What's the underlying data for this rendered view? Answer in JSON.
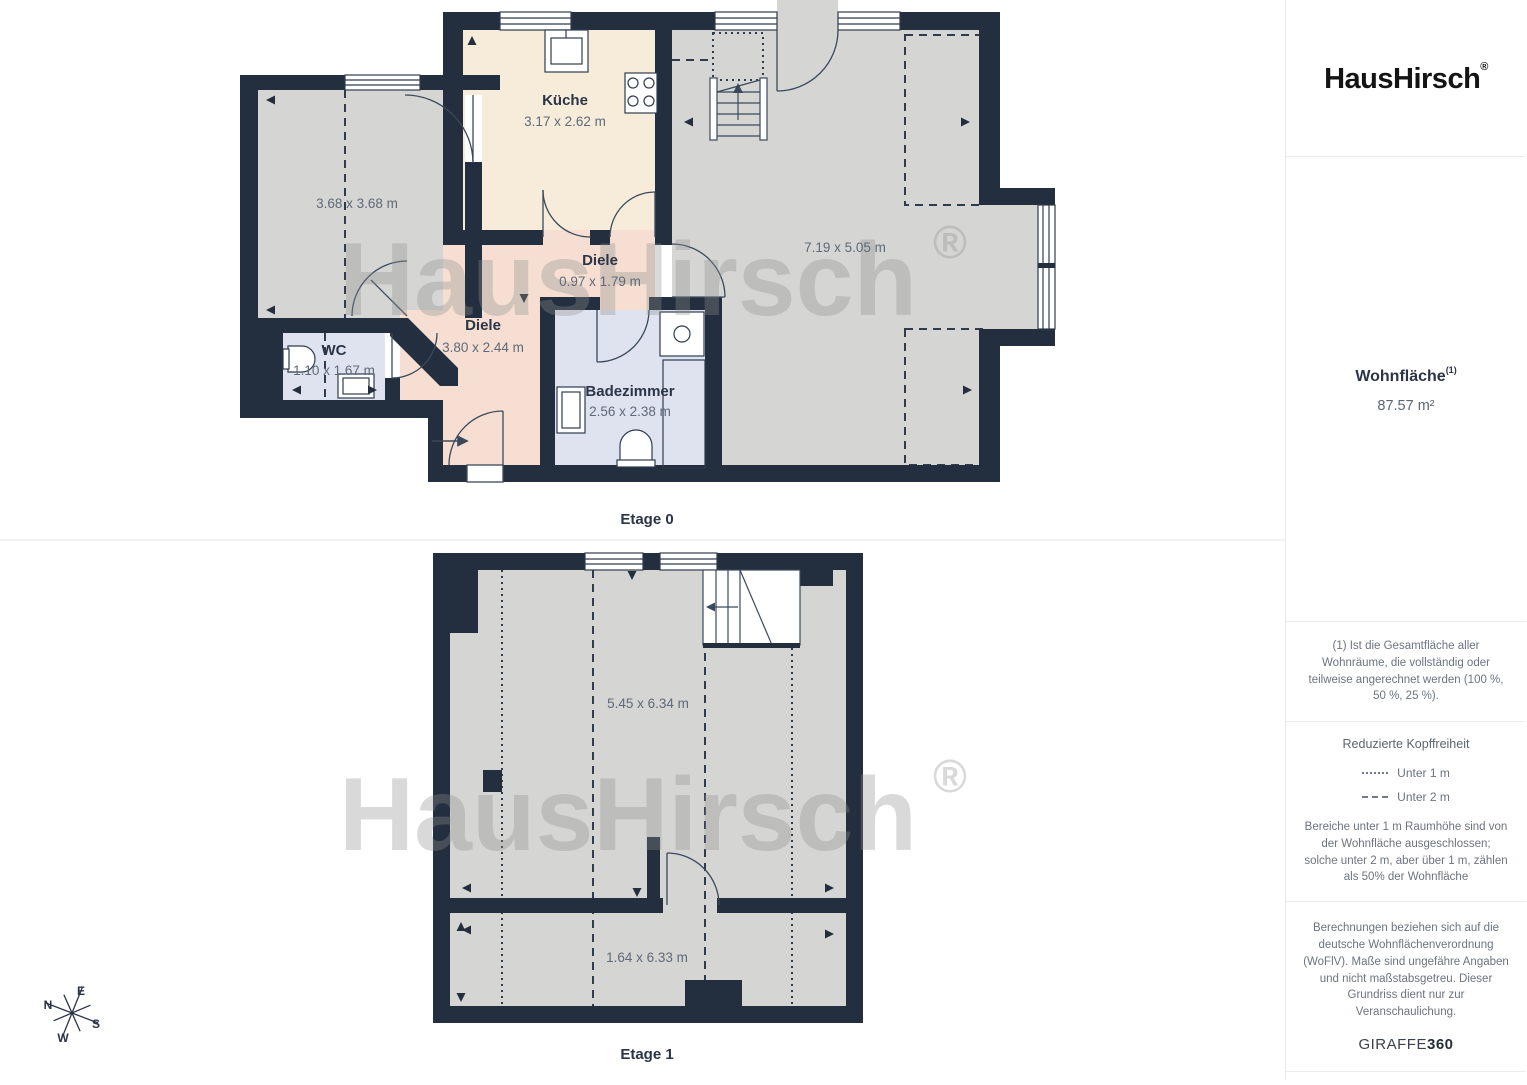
{
  "brand": {
    "logo_text": "HausHirsch",
    "registered": "®"
  },
  "sidebar": {
    "area_label": "Wohnfläche",
    "area_footnote_marker": "(1)",
    "area_value": "87.57 m²",
    "footnote": "(1) Ist die Gesamtfläche aller Wohnräume, die vollständig oder teilweise angerechnet werden (100 %, 50 %, 25 %).",
    "legend": {
      "title": "Reduzierte Kopffreiheit",
      "items": [
        {
          "style": "dotted",
          "label": "Unter 1 m"
        },
        {
          "style": "dashed",
          "label": "Unter 2 m"
        }
      ],
      "description": "Bereiche unter 1 m Raumhöhe sind von der Wohnfläche ausgeschlossen; solche unter 2 m, aber über 1 m, zählen als 50% der Wohnfläche"
    },
    "disclaimer": "Berechnungen beziehen sich auf die deutsche Wohnflächenverordnung (WoFlV). Maße sind ungefähre Angaben und nicht maßstabsgetreu. Dieser Grundriss dient nur zur Veranschaulichung.",
    "vendor_name": "GIRAFFE",
    "vendor_suffix": "360"
  },
  "watermark": {
    "text": "HausHirsch",
    "registered": "®"
  },
  "compass": {
    "n": "N",
    "e": "E",
    "s": "S",
    "w": "W"
  },
  "floors": [
    {
      "label": "Etage 0",
      "rooms": [
        {
          "name": "",
          "dims": "3.68 x 3.68 m"
        },
        {
          "name": "Küche",
          "dims": "3.17 x 2.62 m"
        },
        {
          "name": "",
          "dims": "7.19 x 5.05 m"
        },
        {
          "name": "Diele",
          "dims": "0.97 x 1.79 m"
        },
        {
          "name": "Diele",
          "dims": "3.80 x 2.44 m"
        },
        {
          "name": "WC",
          "dims": "1.10 x 1.67 m"
        },
        {
          "name": "Badezimmer",
          "dims": "2.56 x 2.38 m"
        }
      ]
    },
    {
      "label": "Etage 1",
      "rooms": [
        {
          "name": "",
          "dims": "5.45 x 6.34 m"
        },
        {
          "name": "",
          "dims": "1.64 x 6.33 m"
        }
      ]
    }
  ],
  "colors": {
    "wall": "#232e3e",
    "room_gray": "#d5d5d3",
    "kitchen_beige": "#f6ecd9",
    "hall_pink": "#f6dfd2",
    "bath_blue": "#dfe3ef",
    "label_dark": "#2b3547",
    "label_gray": "#5f6a78"
  }
}
